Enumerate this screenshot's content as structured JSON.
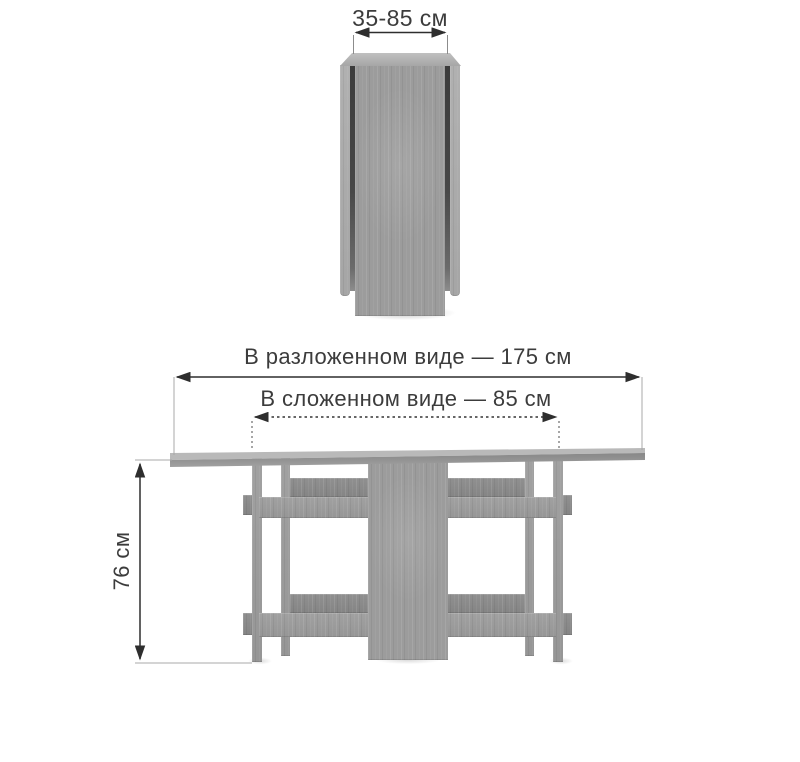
{
  "diagram": {
    "subject": "folding-table-dimension-diagram",
    "views": [
      {
        "name": "folded-front-view"
      },
      {
        "name": "unfolded-front-view"
      }
    ],
    "dimensions": {
      "folded_width": {
        "label": "35-85 см",
        "min_cm": 35,
        "max_cm": 85
      },
      "unfolded_length": {
        "label": "В разложенном виде — 175 см",
        "value_cm": 175
      },
      "folded_length": {
        "label": "В сложенном виде — 85 см",
        "value_cm": 85
      },
      "height": {
        "label": "76 см",
        "value_cm": 76
      }
    },
    "unit": "см"
  },
  "colors": {
    "background": "#ffffff",
    "wood_base": "#9c9c9c",
    "wood_light": "#acacac",
    "wood_dark": "#8a8a8a",
    "wood_top_highlight": "#b9b9b9",
    "gap_shadow": "#3c3c3c",
    "dimension_line": "#2e2e2e",
    "extension_line": "#a8a8a8",
    "label_text": "#3c3c3c"
  }
}
